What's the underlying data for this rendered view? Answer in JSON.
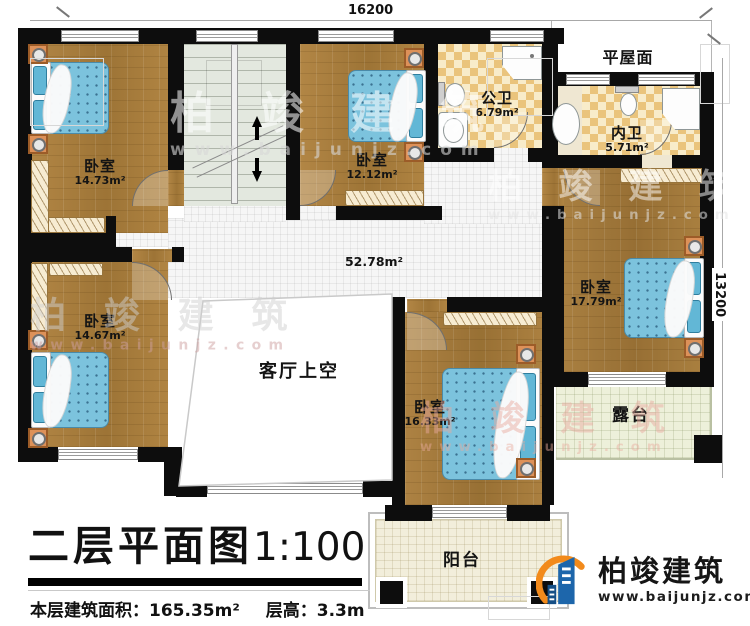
{
  "dimensions": {
    "top": "16200",
    "right": "13200"
  },
  "rooms": {
    "bedroom_top_left": {
      "name": "卧室",
      "area": "14.73m²"
    },
    "bedroom_top_mid": {
      "name": "卧室",
      "area": "12.12m²"
    },
    "public_bath": {
      "name": "公卫",
      "area": "6.79m²"
    },
    "flat_roof": {
      "name": "平屋面"
    },
    "inner_bath": {
      "name": "内卫",
      "area": "5.71m²"
    },
    "bedroom_right": {
      "name": "卧室",
      "area": "17.79m²"
    },
    "bedroom_bottom_mid": {
      "name": "卧室",
      "area": "16.33m²"
    },
    "bedroom_bottom_left": {
      "name": "卧室",
      "area": "14.67m²"
    },
    "hallway": {
      "area": "52.78m²"
    },
    "living_void": {
      "name": "客厅上空"
    },
    "terrace": {
      "name": "露台"
    },
    "balcony": {
      "name": "阳台"
    }
  },
  "footer": {
    "title": "二层平面图",
    "scale": "1:100",
    "area_label": "本层建筑面积：",
    "area_value": "165.35m²",
    "height_label": "层高：",
    "height_value": "3.3m"
  },
  "branding": {
    "company": "柏竣建筑",
    "website": "www.baijunjz.com"
  },
  "colors": {
    "wall": "#0d0d0d",
    "wood": "#a9803f",
    "bed": "#7cc3dd",
    "checker_tile": "#eac47c",
    "logo_blue": "#1d66ab",
    "logo_orange": "#f28a1b"
  }
}
